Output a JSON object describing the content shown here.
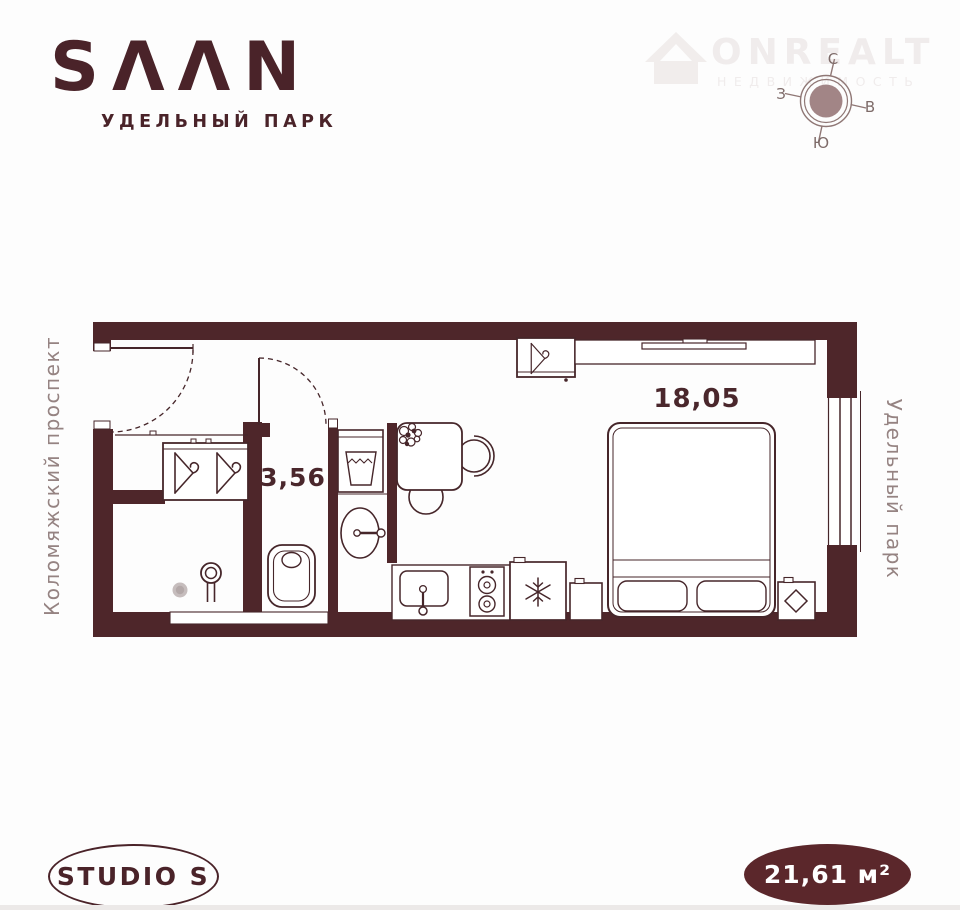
{
  "brand": {
    "logo_text": "SΛΛN",
    "project": "УДЕЛЬНЫЙ ПАРК"
  },
  "watermark": {
    "name": "ONREALT",
    "tagline": "НЕДВИЖИМОСТЬ"
  },
  "compass": {
    "north": "С",
    "east": "В",
    "south": "Ю",
    "west": "З"
  },
  "plan": {
    "living_area_label": "18,05",
    "bath_area_label": "3,56",
    "street_left": "Коломяжский проспект",
    "street_right": "Удельный парк",
    "icons": [
      "entry-door-swing",
      "interior-door-swing",
      "clothes-hanger",
      "toilet",
      "shower-mixer",
      "floor-drain",
      "washbasin",
      "laundry-basket",
      "dining-table",
      "chair",
      "flower-decor",
      "kitchen-sink",
      "stove-burners",
      "refrigerator-snowflake",
      "double-bed",
      "pillows",
      "nightstand",
      "diamond-decor",
      "window",
      "wall-shelf",
      "desk-counter",
      "ventilation-duct"
    ]
  },
  "badges": {
    "layout": "STUDIO S",
    "area": "21,61 м²"
  },
  "colors": {
    "wall_fill": "#4e262a",
    "line": "#46262a",
    "brand": "#4a2329",
    "area_badge_fill": "#5b272b",
    "street_text": "#958382",
    "compass_ring": "#8f7775",
    "compass_center_fill": "#a28586",
    "watermark_text": "#f0ecec",
    "drain_gray": "#c6bdbd"
  }
}
